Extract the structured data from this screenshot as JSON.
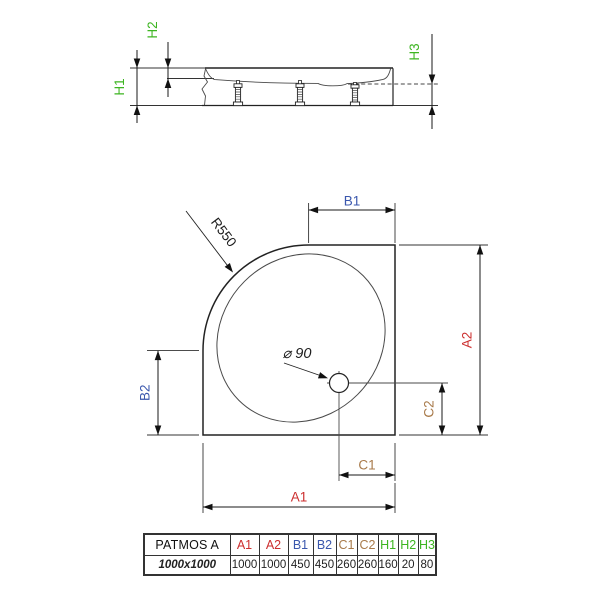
{
  "colors": {
    "dim_red": "#cc2e2e",
    "dim_blue": "#3a57ad",
    "dim_brown": "#a87a4a",
    "dim_green": "#3db521",
    "line": "#222222"
  },
  "side_view": {
    "h1_label": "H1",
    "h2_label": "H2",
    "h3_label": "H3"
  },
  "plan_view": {
    "a1_label": "A1",
    "a2_label": "A2",
    "b1_label": "B1",
    "b2_label": "B2",
    "c1_label": "C1",
    "c2_label": "C2",
    "radius_label": "R550",
    "drain_label": "⌀ 90"
  },
  "spec_table": {
    "product_name": "PATMOS A",
    "size_label": "1000x1000",
    "headers": [
      "A1",
      "A2",
      "B1",
      "B2",
      "C1",
      "C2",
      "H1",
      "H2",
      "H3"
    ],
    "values": [
      "1000",
      "1000",
      "450",
      "450",
      "260",
      "260",
      "160",
      "20",
      "80"
    ]
  }
}
